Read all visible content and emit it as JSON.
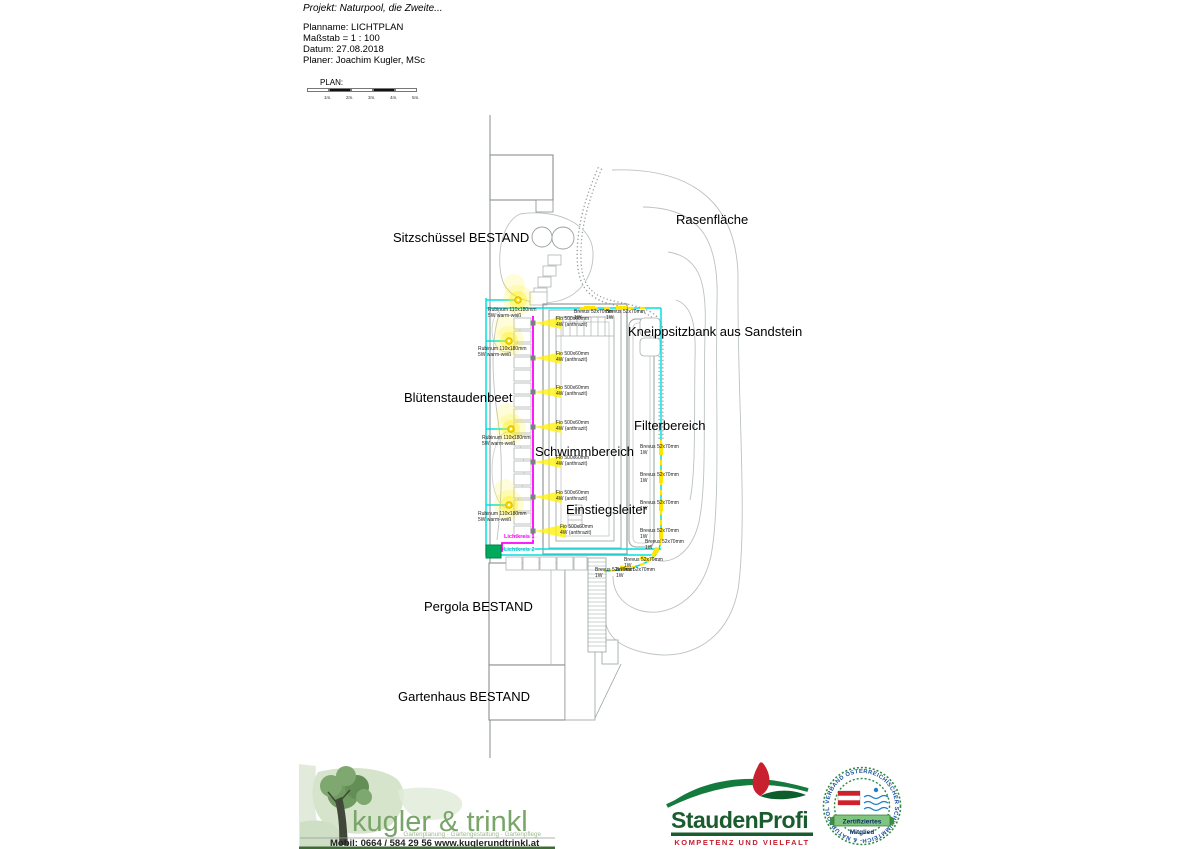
{
  "header": {
    "project": "Projekt: Naturpool, die Zweite...",
    "plan_name": "Planname: LICHTPLAN",
    "scale": "Maßstab = 1 : 100",
    "date": "Datum: 27.08.2018",
    "planner": "Planer: Joachim Kugler, MSc"
  },
  "scale_bar": {
    "title": "PLAN:",
    "ticks": [
      "1m.",
      "2m.",
      "3m.",
      "4m.",
      "5m."
    ]
  },
  "plan": {
    "area_labels": {
      "sitzschuessel": "Sitzschüssel BESTAND",
      "rasenflaeche": "Rasenfläche",
      "kneippsitzbank": "Kneippsitzbank aus Sandstein",
      "bluetenstaudenbeet": "Blütenstaudenbeet",
      "filterbereich": "Filterbereich",
      "schwimmbereich": "Schwimmbereich",
      "einstiegsleiter": "Einstiegsleiter",
      "pergola": "Pergola BESTAND",
      "gartenhaus": "Gartenhaus BESTAND"
    },
    "fixtures": {
      "rubinum": {
        "line1": "Rubinum 110x180mm",
        "line2": "5W warm-weiß"
      },
      "fio": {
        "line1": "Fio 500x60mm",
        "line2": "4W (anthrazit)"
      },
      "brevus": {
        "line1": "Brevus 52x70mm",
        "line2": "1W"
      }
    },
    "circuits": {
      "circuit1": "Lichtkreis 1",
      "circuit2": "Lichtkreis 2"
    },
    "colors": {
      "circuit1_cable": "#ff00ff",
      "circuit2_cable": "#00e0e0",
      "light_yellow": "#ffe600",
      "supply_box_green": "#00a95c"
    }
  },
  "footer": {
    "kugler": {
      "name": "kugler & trinkl",
      "tagline": "Gartenplanung · Gartengestaltung · Gartenpflege",
      "contact": "Mobil: 0664 / 584 29 56  www.kuglerundtrinkl.at"
    },
    "stauden": {
      "name": "StaudenProfi",
      "tagline": "KOMPETENZ UND VIELFALT"
    },
    "badge": {
      "ring_text": "VERBAND ÖSTERREICHISCHER SCHWIMMTEICH- & NATURPOOLBAU •",
      "line1": "Zertifiziertes",
      "line2": "Mitglied"
    }
  }
}
